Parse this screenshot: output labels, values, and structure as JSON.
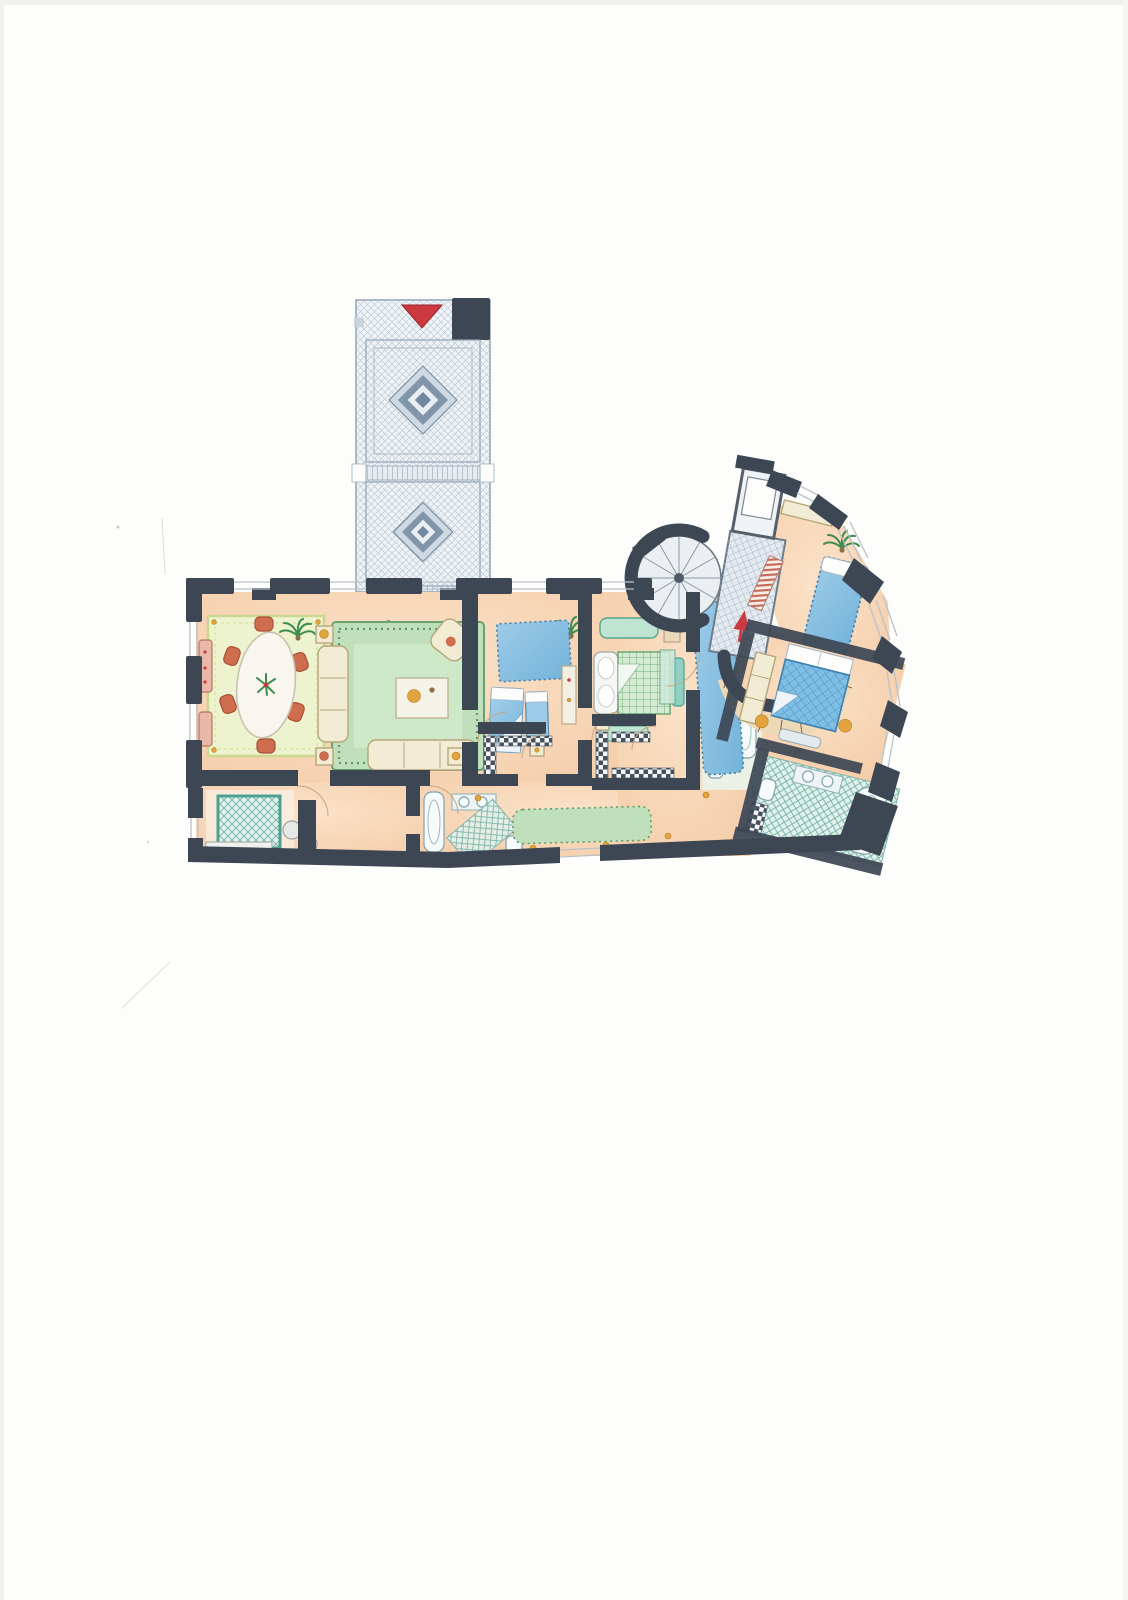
{
  "document": {
    "kind": "Scanned hand-drawn watercolor apartment floor plan on a white page",
    "visible_text": [],
    "markers": {
      "entry_arrow": "solid red triangle pointing down at the top gallery entrance",
      "vestibule_arrow": "small red arrow drawn inside the tiled elevator vestibule"
    }
  },
  "rooms": [
    {
      "id": "entry-gallery",
      "label": "tiled entry gallery with two diamond-motif floor panels"
    },
    {
      "id": "dining-room",
      "label": "dining room with oval table, six terracotta chairs, patterned rug"
    },
    {
      "id": "living-room",
      "label": "living room with green rug, two cream sofas, armchair, coffee table"
    },
    {
      "id": "twin-bedroom",
      "label": "bedroom with blue rug and two single beds"
    },
    {
      "id": "double-bedroom",
      "label": "bedroom with green checked double bed and teal daybed"
    },
    {
      "id": "guest-bedroom",
      "label": "rotated bedroom with blue bed against window wall"
    },
    {
      "id": "master-bedroom",
      "label": "rotated bedroom with blue gridded double bed and lamps"
    },
    {
      "id": "master-bathroom",
      "label": "teal checked bathroom with tub, twin sinks, toilet"
    },
    {
      "id": "kitchen",
      "label": "kitchen with teal cross-hatched table and stools"
    },
    {
      "id": "bathroom",
      "label": "bathroom with bathtub, sink and teal floor"
    },
    {
      "id": "walk-in-closet-1",
      "label": "closet with checkered shelving strips"
    },
    {
      "id": "walk-in-closet-2",
      "label": "closet with checkered shelving strips"
    },
    {
      "id": "green-bathroom",
      "label": "small bathroom with pale green fixtures"
    },
    {
      "id": "hallway",
      "label": "bottom corridor with long green runner rug"
    },
    {
      "id": "inner-hall",
      "label": "hall with long blue runner rug"
    },
    {
      "id": "spiral-staircase",
      "label": "round spiral stair with radial treads"
    },
    {
      "id": "elevator-vestibule",
      "label": "fine-grid tiled vestibule with elevator and curved step band"
    }
  ],
  "colors": {
    "paper": "#fdfdfc",
    "wall": "#3d4754",
    "floor": "#f4cda9",
    "floorSoft": "#fbe2c9",
    "tile": "#f1f4f7",
    "tileLine": "#a9bac8",
    "diamondDark": "#8196ab",
    "diamondMid": "#b7c5d2",
    "rugGreen": "#bfe0ba",
    "rugGreenDeep": "#5f9b68",
    "rugLime": "#eef3cf",
    "rugLimeEdge": "#c9d88e",
    "cream": "#f3ecd4",
    "creamEdge": "#b5a67c",
    "blue": "#74b3da",
    "blueLight": "#9ccbe8",
    "blueDeep": "#3f7fae",
    "teal": "#8fd0c2",
    "tealDeep": "#4d9f8f",
    "terracotta": "#cf6e4e",
    "red": "#cc3a40",
    "gold": "#e2a43e",
    "plant": "#3f8d4f",
    "tread": "#ecd9b8",
    "treadEdge": "#8a6f4d",
    "glaze": "#b9c2ca"
  }
}
